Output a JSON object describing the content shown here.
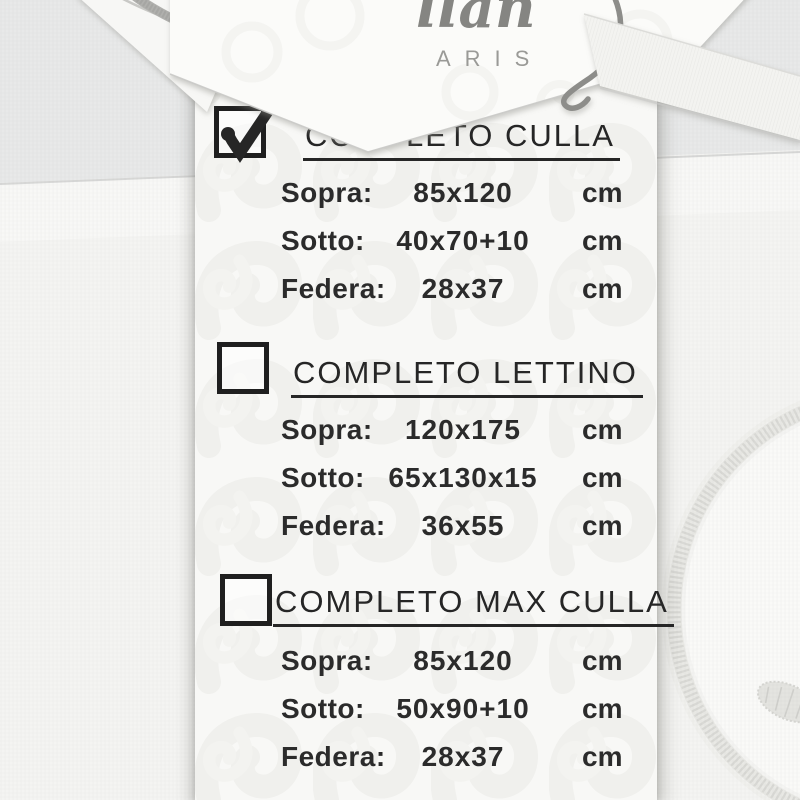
{
  "brand": {
    "script_text": "llan",
    "subtext": "ARIS"
  },
  "tag": {
    "sections": [
      {
        "checked": true,
        "title": "COMPLETO CULLA",
        "rows": [
          {
            "name": "Sopra:",
            "value": "85x120",
            "unit": "cm"
          },
          {
            "name": "Sotto:",
            "value": "40x70+10",
            "unit": "cm"
          },
          {
            "name": "Federa:",
            "value": "28x37",
            "unit": "cm"
          }
        ]
      },
      {
        "checked": false,
        "title": "COMPLETO LETTINO",
        "rows": [
          {
            "name": "Sopra:",
            "value": "120x175",
            "unit": "cm"
          },
          {
            "name": "Sotto:",
            "value": "65x130x15",
            "unit": "cm"
          },
          {
            "name": "Federa:",
            "value": "36x55",
            "unit": "cm"
          }
        ]
      },
      {
        "checked": false,
        "title": "COMPLETO MAX CULLA",
        "rows": [
          {
            "name": "Sopra:",
            "value": "85x120",
            "unit": "cm"
          },
          {
            "name": "Sotto:",
            "value": "50x90+10",
            "unit": "cm"
          },
          {
            "name": "Federa:",
            "value": "28x37",
            "unit": "cm"
          }
        ]
      }
    ]
  },
  "colors": {
    "ink": "#262626",
    "tag_paper": "#f8f8f6",
    "tag_pattern": "#e9e9e5",
    "fabric_gray": "#e8e9e9",
    "fabric_white": "#f4f4f2",
    "silver_embroidery": "#b0b0ad",
    "ribbon": "#f3f3f0"
  }
}
